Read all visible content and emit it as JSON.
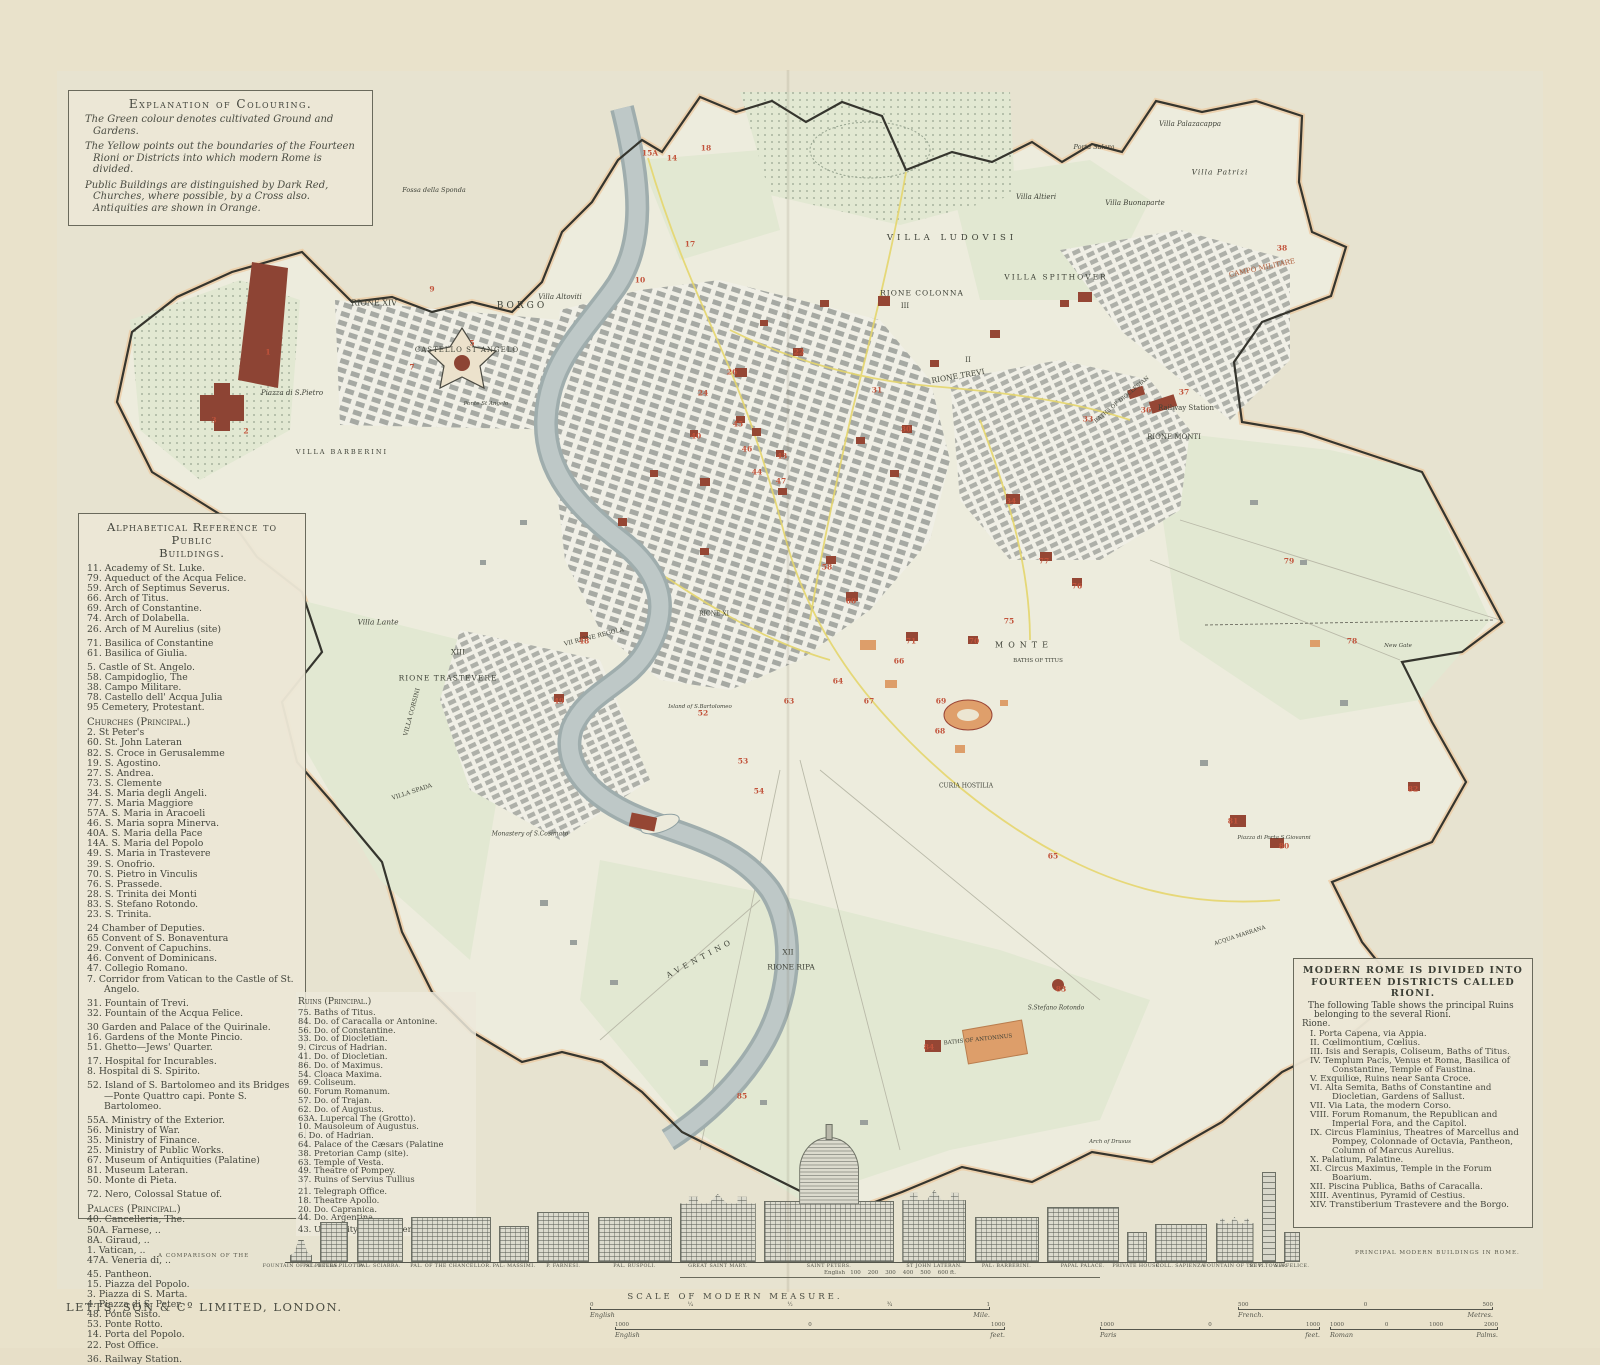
{
  "header": {
    "publisher_line1": "LETTS'S",
    "publisher_line2": "POPULAR ATLAS.",
    "title_main": "CITY OF ROME",
    "title_sub": "AS IT IS IN 1882.",
    "scale_note": "Scale : 4 Inches to the Mile."
  },
  "explanation": {
    "title": "Explanation of Colouring.",
    "paragraphs": [
      "The Green colour denotes cultivated Ground and Gardens.",
      "The Yellow points out the boundaries of the Fourteen Rioni or Districts into which modern Rome is divided.",
      "Public Buildings are distinguished by Dark Red, Churches, where possible, by a Cross also. Antiquities are shown in Orange."
    ]
  },
  "reference": {
    "title_line1": "Alphabetical Reference to Public",
    "title_line2": "Buildings.",
    "groups": [
      {
        "heading": "",
        "items": [
          "11. Academy of St. Luke.",
          "79. Aqueduct of the Acqua Felice.",
          "59. Arch of Septimus Severus.",
          "66. Arch of Titus.",
          "69. Arch of Constantine.",
          "74. Arch of Dolabella.",
          "26. Arch of M Aurelius (site)"
        ]
      },
      {
        "heading": "",
        "items": [
          "71. Basilica of Constantine",
          "61. Basilica of Giulia."
        ]
      },
      {
        "heading": "",
        "items": [
          "5. Castle of St. Angelo.",
          "58. Campidoglio, The",
          "38. Campo Militare.",
          "78. Castello dell' Acqua Julia",
          "95 Cemetery, Protestant."
        ]
      },
      {
        "heading": "Churches (Principal.)",
        "items": [
          "2. St Peter's",
          "60. St. John Lateran",
          "82. S. Croce in Gerusalemme",
          "19. S. Agostino.",
          "27. S. Andrea.",
          "73. S. Clemente",
          "34. S. Maria degli Angeli.",
          "77. S. Maria Maggiore",
          "57A. S. Maria in Aracoeli",
          "46. S. Maria sopra Minerva.",
          "40A. S. Maria della Pace",
          "14A. S. Maria del Popolo",
          "49. S. Maria in Trastevere",
          "39. S. Onofrio.",
          "70. S. Pietro in Vinculis",
          "76. S. Prassede.",
          "28. S. Trinita dei Monti",
          "83. S. Stefano Rotondo.",
          "23. S. Trinita."
        ]
      },
      {
        "heading": "",
        "items": [
          "24 Chamber of Deputies.",
          "65 Convent of S. Bonaventura",
          "29. Convent of Capuchins.",
          "46. Convent of Dominicans.",
          "47. Collegio Romano.",
          "7. Corridor from Vatican to the Castle of St. Angelo."
        ]
      },
      {
        "heading": "",
        "items": [
          "31. Fountain of Trevi.",
          "32. Fountain of the Acqua Felice."
        ]
      },
      {
        "heading": "",
        "items": [
          "30 Garden and Palace of the Quirinale.",
          "16. Gardens of the Monte Pincio.",
          "51. Ghetto—Jews' Quarter."
        ]
      },
      {
        "heading": "",
        "items": [
          "17. Hospital for Incurables.",
          "8. Hospital di S. Spirito."
        ]
      },
      {
        "heading": "",
        "items": [
          "52. Island of S. Bartolomeo and its Bridges—Ponte Quattro capi. Ponte S. Bartolomeo."
        ]
      },
      {
        "heading": "",
        "items": [
          "55A. Ministry of the Exterior.",
          "56. Ministry of War.",
          "35. Ministry of Finance.",
          "25. Ministry of Public Works.",
          "67. Museum of Antiquities (Palatine)",
          "81. Museum Lateran.",
          "50. Monte di Pieta."
        ]
      },
      {
        "heading": "",
        "items": [
          "72. Nero, Colossal Statue of."
        ]
      },
      {
        "heading": "Palaces (Principal.)",
        "items": [
          "40. Cancelleria, The.",
          "50A. Farnese,  ..",
          "8A. Giraud,  ..",
          "1. Vatican,  ..",
          "47A. Veneria di,  .."
        ]
      },
      {
        "heading": "",
        "items": [
          "45. Pantheon.",
          "15. Piazza del Popolo.",
          "3. Piazza di S. Marta.",
          "4. Piazza di S. Peter.",
          "48. Ponte Sisto.",
          "53. Ponte Rotto.",
          "14. Porta del Popolo.",
          "22. Post Office."
        ]
      },
      {
        "heading": "",
        "items": [
          "36. Railway Station."
        ]
      }
    ]
  },
  "ruins": {
    "groups": [
      {
        "heading": "Ruins (Principal.)",
        "items": [
          "75. Baths of Titus.",
          "84. Do. of Caracalla or Antonine.",
          "56. Do. of Constantine.",
          "33. Do. of Diocletian.",
          "9. Circus of Hadrian.",
          "41. Do. of Diocletian.",
          "86. Do. of Maximus.",
          "54. Cloaca Maxima.",
          "69. Coliseum.",
          "60. Forum Romanum.",
          "57. Do. of Trajan.",
          "62. Do. of Augustus.",
          "63A. Lupercal The (Grotto).",
          "10. Mausoleum of Augustus.",
          "6. Do. of Hadrian.",
          "64. Palace of the Cæsars (Palatine",
          "38. Pretorian Camp (site).",
          "63. Temple of Vesta.",
          "49. Theatre of Pompey.",
          "37. Ruins of Servius Tullius"
        ]
      },
      {
        "heading": "",
        "items": [
          "21. Telegraph Office.",
          "18. Theatre Apollo.",
          "20. Do. Capranica.",
          "44. Do. Argentina."
        ]
      },
      {
        "heading": "",
        "items": [
          "43. University della Sapienza."
        ]
      }
    ]
  },
  "rioni": {
    "title": "MODERN ROME IS DIVIDED INTO FOURTEEN DISTRICTS CALLED RIONI.",
    "intro": "The following Table shows the principal Ruins belonging to the several Rioni.",
    "rione_label": "Rione.",
    "items": [
      "I. Porta Capena, via Appia.",
      "II. Cœlimontium, Cœlius.",
      "III. Isis and Serapis, Coliseum, Baths of Titus.",
      "IV. Templum Pacis, Venus et Roma, Basilica of Constantine, Temple of Faustina.",
      "V. Exquiliœ, Ruins near Santa Croce.",
      "VI. Alta Semita, Baths of Constantine and Diocletian, Gardens of Sallust.",
      "VII. Via Lata, the modern Corso.",
      "VIII. Forum Romanum, the Republican and Imperial Fora, and the Capitol.",
      "IX. Circus Flaminius, Theatres of Marcellus and Pompey, Colonnade of Octavia, Pantheon, Column of Marcus Aurelius.",
      "X. Palatium, Palatine.",
      "XI. Circus Maximus, Temple in the Forum Boarium.",
      "XII. Piscina Publica, Baths of Caracalla.",
      "XIII. Aventinus, Pyramid of Cestius.",
      "XIV. Transtiberium Trastevere and the Borgo."
    ]
  },
  "buildings": {
    "left_note": "A COMPARISON OF THE",
    "right_note": "PRINCIPAL MODERN BUILDINGS IN ROME.",
    "mini_scale": "English   100    200    300    400    500    600 ft.",
    "items": [
      {
        "label": "FOUNTAIN OF ST PETERS.",
        "type": "fountain",
        "w": 22,
        "h": 22
      },
      {
        "label": "PAL: DELLA PILOTTA.",
        "type": "palace",
        "w": 28,
        "h": 40
      },
      {
        "label": "PAL: SCIARRA.",
        "type": "palace",
        "w": 46,
        "h": 44
      },
      {
        "label": "PAL. OF THE CHANCELLOR.",
        "type": "palace",
        "w": 80,
        "h": 45
      },
      {
        "label": "PAL: MASSIMI.",
        "type": "palace",
        "w": 30,
        "h": 36
      },
      {
        "label": "P. FARNESI.",
        "type": "palace",
        "w": 52,
        "h": 50
      },
      {
        "label": "PAL. RUSPOLI.",
        "type": "palace",
        "w": 74,
        "h": 45
      },
      {
        "label": "GREAT SAINT MARY.",
        "type": "basilica",
        "w": 76,
        "h": 68
      },
      {
        "label": "SAINT PETERS.",
        "type": "dome",
        "w": 130,
        "h": 160
      },
      {
        "label": "ST JOHN LATERAN.",
        "type": "basilica",
        "w": 64,
        "h": 72
      },
      {
        "label": "PAL: BARBERINI.",
        "type": "palace",
        "w": 64,
        "h": 45
      },
      {
        "label": "PAPAL PALACE.",
        "type": "palace",
        "w": 72,
        "h": 55
      },
      {
        "label": "PRIVATE HOUSE.",
        "type": "house",
        "w": 20,
        "h": 30
      },
      {
        "label": "COLL. SAPIENZA.",
        "type": "palace",
        "w": 52,
        "h": 38
      },
      {
        "label": "FOUNTAIN OF TREVI.",
        "type": "church",
        "w": 38,
        "h": 45
      },
      {
        "label": "ST P. TOWER.",
        "type": "tower",
        "w": 14,
        "h": 90
      },
      {
        "label": "S.A FELICE.",
        "type": "house",
        "w": 16,
        "h": 30
      }
    ]
  },
  "footer": {
    "imprint": "LETTS, SON & Cº LIMITED, LONDON.",
    "scale_title": "SCALE OF MODERN MEASURE.",
    "bars": [
      {
        "left": "English",
        "right": "Mile.",
        "numbers": [
          "0",
          "¼",
          "½",
          "¾",
          "1"
        ]
      },
      {
        "left": "English",
        "right": "feet.",
        "numbers": [
          "1000",
          "0",
          "1000"
        ]
      },
      {
        "left": "Paris",
        "right": "feet.",
        "numbers": [
          "1000",
          "0",
          "1000"
        ]
      },
      {
        "left": "French.",
        "right": "Metres.",
        "numbers": [
          "500",
          "0",
          "500"
        ]
      },
      {
        "left": "Roman",
        "right": "Palms.",
        "numbers": [
          "1000",
          "0",
          "1000",
          "2000"
        ]
      }
    ]
  },
  "map": {
    "colors": {
      "green": "#e2e8d2",
      "yellow": "#e5d66d",
      "dark_red": "#954634",
      "orange": "#df9f6b",
      "river": "#b5bfbf",
      "wall": "#35352e"
    },
    "labels": [
      {
        "t": "RIONE XIV",
        "x": 374,
        "y": 303,
        "s": 8
      },
      {
        "t": "BORGO",
        "x": 522,
        "y": 306,
        "s": 9,
        "ls": 3
      },
      {
        "t": "CASTELLO ST ANGELO",
        "x": 467,
        "y": 350,
        "s": 7,
        "ls": 1
      },
      {
        "t": "Piazza di S.Pietro",
        "x": 292,
        "y": 393,
        "s": 7,
        "i": 1
      },
      {
        "t": "VILLA BARBERINI",
        "x": 342,
        "y": 452,
        "s": 6.5,
        "ls": 2
      },
      {
        "t": "Villa Lante",
        "x": 378,
        "y": 622,
        "s": 7.5,
        "i": 1
      },
      {
        "t": "XIII",
        "x": 458,
        "y": 652,
        "s": 7.5
      },
      {
        "t": "RIONE TRASTEVERE",
        "x": 448,
        "y": 678,
        "s": 7.5,
        "ls": 1
      },
      {
        "t": "VILLA CORSINI",
        "x": 412,
        "y": 712,
        "s": 6,
        "r": -75
      },
      {
        "t": "VILLA SPADA",
        "x": 412,
        "y": 792,
        "s": 6,
        "r": -18
      },
      {
        "t": "Monastery of S.Cosimato",
        "x": 530,
        "y": 834,
        "s": 6,
        "i": 1
      },
      {
        "t": "VII RIONE REGOLA",
        "x": 594,
        "y": 637,
        "s": 6,
        "r": -14
      },
      {
        "t": "RIONE XI",
        "x": 714,
        "y": 614,
        "s": 6
      },
      {
        "t": "Island of S.Bartolomeo",
        "x": 700,
        "y": 707,
        "s": 5.5,
        "i": 1
      },
      {
        "t": "Villa Altoviti",
        "x": 560,
        "y": 297,
        "s": 7,
        "i": 1
      },
      {
        "t": "Fossa della Sponda",
        "x": 434,
        "y": 190,
        "s": 6.5,
        "i": 1
      },
      {
        "t": "VILLA LUDOVISI",
        "x": 952,
        "y": 238,
        "s": 8.5,
        "ls": 4
      },
      {
        "t": "RIONE COLONNA",
        "x": 922,
        "y": 293,
        "s": 7.5,
        "ls": 1
      },
      {
        "t": "III",
        "x": 905,
        "y": 306,
        "s": 7
      },
      {
        "t": "VILLA SPITHOVER",
        "x": 1056,
        "y": 277,
        "s": 7.5,
        "ls": 2
      },
      {
        "t": "RIONE TREVI",
        "x": 958,
        "y": 376,
        "s": 7.5,
        "r": -10
      },
      {
        "t": "II",
        "x": 968,
        "y": 360,
        "s": 7
      },
      {
        "t": "RIONE MONTI",
        "x": 1174,
        "y": 437,
        "s": 7
      },
      {
        "t": "Villa Altieri",
        "x": 1036,
        "y": 197,
        "s": 7,
        "i": 1
      },
      {
        "t": "Villa Buonaparte",
        "x": 1135,
        "y": 203,
        "s": 7,
        "i": 1
      },
      {
        "t": "Porta Salara",
        "x": 1094,
        "y": 147,
        "s": 6.5,
        "i": 1
      },
      {
        "t": "Villa Patrizi",
        "x": 1220,
        "y": 172,
        "s": 7.5,
        "i": 1,
        "ls": 1
      },
      {
        "t": "Villa Palazacappa",
        "x": 1190,
        "y": 124,
        "s": 7,
        "i": 1
      },
      {
        "t": "CAMPO MILITARE",
        "x": 1262,
        "y": 268,
        "s": 7,
        "r": -12,
        "c": "#b0603e"
      },
      {
        "t": "Railway Station",
        "x": 1186,
        "y": 408,
        "s": 7
      },
      {
        "t": "BATHS OF DIOCLESIAN",
        "x": 1122,
        "y": 400,
        "s": 5.5,
        "r": -40
      },
      {
        "t": "MONTE",
        "x": 1024,
        "y": 645,
        "s": 8,
        "ls": 5
      },
      {
        "t": "BATHS OF TITUS",
        "x": 1038,
        "y": 661,
        "s": 5.5
      },
      {
        "t": "CURIA HOSTILIA",
        "x": 966,
        "y": 786,
        "s": 6
      },
      {
        "t": "XII",
        "x": 788,
        "y": 952,
        "s": 7.5
      },
      {
        "t": "RIONE RIPA",
        "x": 791,
        "y": 967,
        "s": 7.5
      },
      {
        "t": "AVENTINO",
        "x": 700,
        "y": 958,
        "s": 7.5,
        "ls": 4,
        "r": -28
      },
      {
        "t": "BATHS OF ANTONINUS",
        "x": 978,
        "y": 1040,
        "s": 5.5,
        "r": -6
      },
      {
        "t": "S.Stefano Rotondo",
        "x": 1056,
        "y": 1008,
        "s": 6,
        "i": 1
      },
      {
        "t": "Piazza di Porta S.Giovanni",
        "x": 1274,
        "y": 838,
        "s": 5.5,
        "i": 1
      },
      {
        "t": "Arch of Drusus",
        "x": 1110,
        "y": 1142,
        "s": 5.5,
        "i": 1
      },
      {
        "t": "ACQUA MARRANA",
        "x": 1240,
        "y": 936,
        "s": 5.5,
        "r": -18
      },
      {
        "t": "Ponte St Angelo",
        "x": 486,
        "y": 404,
        "s": 5.5,
        "i": 1
      },
      {
        "t": "New Gate",
        "x": 1398,
        "y": 646,
        "s": 5.5,
        "i": 1
      }
    ],
    "markers": [
      {
        "n": "15A",
        "x": 650,
        "y": 153
      },
      {
        "n": "14",
        "x": 672,
        "y": 158
      },
      {
        "n": "18",
        "x": 706,
        "y": 148
      },
      {
        "n": "17",
        "x": 690,
        "y": 244
      },
      {
        "n": "10",
        "x": 640,
        "y": 280
      },
      {
        "n": "9",
        "x": 432,
        "y": 289
      },
      {
        "n": "1",
        "x": 268,
        "y": 352
      },
      {
        "n": "2",
        "x": 246,
        "y": 431
      },
      {
        "n": "3",
        "x": 214,
        "y": 420
      },
      {
        "n": "5",
        "x": 472,
        "y": 343
      },
      {
        "n": "7",
        "x": 412,
        "y": 367
      },
      {
        "n": "26",
        "x": 732,
        "y": 372
      },
      {
        "n": "45",
        "x": 738,
        "y": 424
      },
      {
        "n": "40",
        "x": 696,
        "y": 436
      },
      {
        "n": "43",
        "x": 782,
        "y": 456
      },
      {
        "n": "44",
        "x": 757,
        "y": 472
      },
      {
        "n": "22",
        "x": 799,
        "y": 352
      },
      {
        "n": "31",
        "x": 877,
        "y": 390
      },
      {
        "n": "30",
        "x": 906,
        "y": 429
      },
      {
        "n": "24",
        "x": 703,
        "y": 393
      },
      {
        "n": "46",
        "x": 747,
        "y": 449
      },
      {
        "n": "47",
        "x": 781,
        "y": 481
      },
      {
        "n": "58",
        "x": 827,
        "y": 567
      },
      {
        "n": "60",
        "x": 851,
        "y": 601
      },
      {
        "n": "64",
        "x": 838,
        "y": 681
      },
      {
        "n": "63",
        "x": 789,
        "y": 701
      },
      {
        "n": "66",
        "x": 899,
        "y": 661
      },
      {
        "n": "71",
        "x": 911,
        "y": 641
      },
      {
        "n": "69",
        "x": 941,
        "y": 701
      },
      {
        "n": "68",
        "x": 940,
        "y": 731
      },
      {
        "n": "67",
        "x": 869,
        "y": 701
      },
      {
        "n": "75",
        "x": 1009,
        "y": 621
      },
      {
        "n": "78",
        "x": 1352,
        "y": 641
      },
      {
        "n": "79",
        "x": 1289,
        "y": 561
      },
      {
        "n": "33",
        "x": 1088,
        "y": 419
      },
      {
        "n": "36",
        "x": 1146,
        "y": 410
      },
      {
        "n": "37",
        "x": 1184,
        "y": 392
      },
      {
        "n": "38",
        "x": 1282,
        "y": 248
      },
      {
        "n": "34",
        "x": 1011,
        "y": 501
      },
      {
        "n": "83",
        "x": 1061,
        "y": 989
      },
      {
        "n": "84",
        "x": 929,
        "y": 1047
      },
      {
        "n": "81",
        "x": 1233,
        "y": 821
      },
      {
        "n": "80",
        "x": 1284,
        "y": 846
      },
      {
        "n": "82",
        "x": 1413,
        "y": 789
      },
      {
        "n": "52",
        "x": 703,
        "y": 713
      },
      {
        "n": "53",
        "x": 743,
        "y": 761
      },
      {
        "n": "54",
        "x": 759,
        "y": 791
      },
      {
        "n": "48",
        "x": 584,
        "y": 641
      },
      {
        "n": "49",
        "x": 559,
        "y": 701
      },
      {
        "n": "76",
        "x": 1077,
        "y": 586
      },
      {
        "n": "77",
        "x": 1044,
        "y": 561
      },
      {
        "n": "70",
        "x": 974,
        "y": 641
      },
      {
        "n": "85",
        "x": 742,
        "y": 1096
      },
      {
        "n": "65",
        "x": 1053,
        "y": 856
      }
    ]
  }
}
